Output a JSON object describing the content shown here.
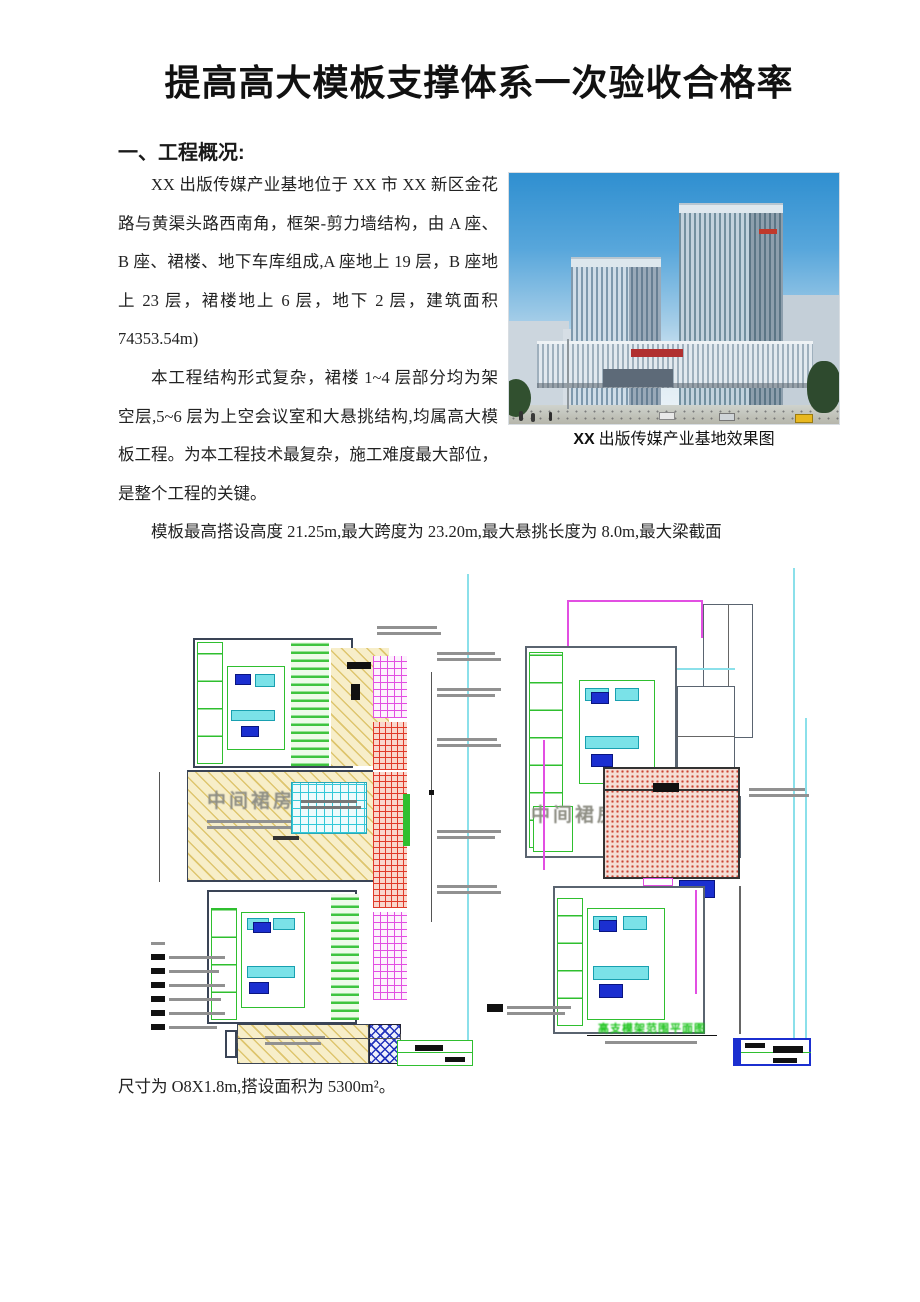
{
  "document": {
    "title": "提高高大模板支撑体系一次验收合格率",
    "heading": "一、工程概况:",
    "p1": "XX 出版传媒产业基地位于 XX 市 XX 新区金花路与黄渠头路西南角，框架-剪力墙结构，由 A 座、B 座、裙楼、地下车库组成,A 座地上 19 层，B 座地上 23 层，裙楼地上 6 层，地下 2 层，建筑面积 74353.54m)",
    "p2": "本工程结构形式复杂，裙楼 1~4 层部分均为架空层,5~6 层为上空会议室和大悬挑结构,均属高大模板工程。为本工程技术最复杂，施工难度最大部位，是整个工程的关键。",
    "p3": "模板最高搭设高度 21.25m,最大跨度为 23.20m,最大悬挑长度为 8.0m,最大梁截面",
    "p4": "尺寸为 O8X1.8m,搭设面积为 5300m²。"
  },
  "figure": {
    "caption_bold": "XX",
    "caption_rest": " 出版传媒产业基地效果图"
  },
  "plans": {
    "left": {
      "area_label": "中间裙房"
    },
    "right": {
      "area_label": "中间裙房",
      "caption": "高支模架范围平面图"
    }
  },
  "colors": {
    "plan_green": "#2fbf2f",
    "plan_magenta": "#e24fe2",
    "plan_red": "#e03a2a",
    "plan_cyan": "#34c8d8",
    "plan_yellow_hatch": "#f7eec9",
    "plan_blue": "#1b2fd0",
    "sky_blue": "#2f8fd0"
  }
}
